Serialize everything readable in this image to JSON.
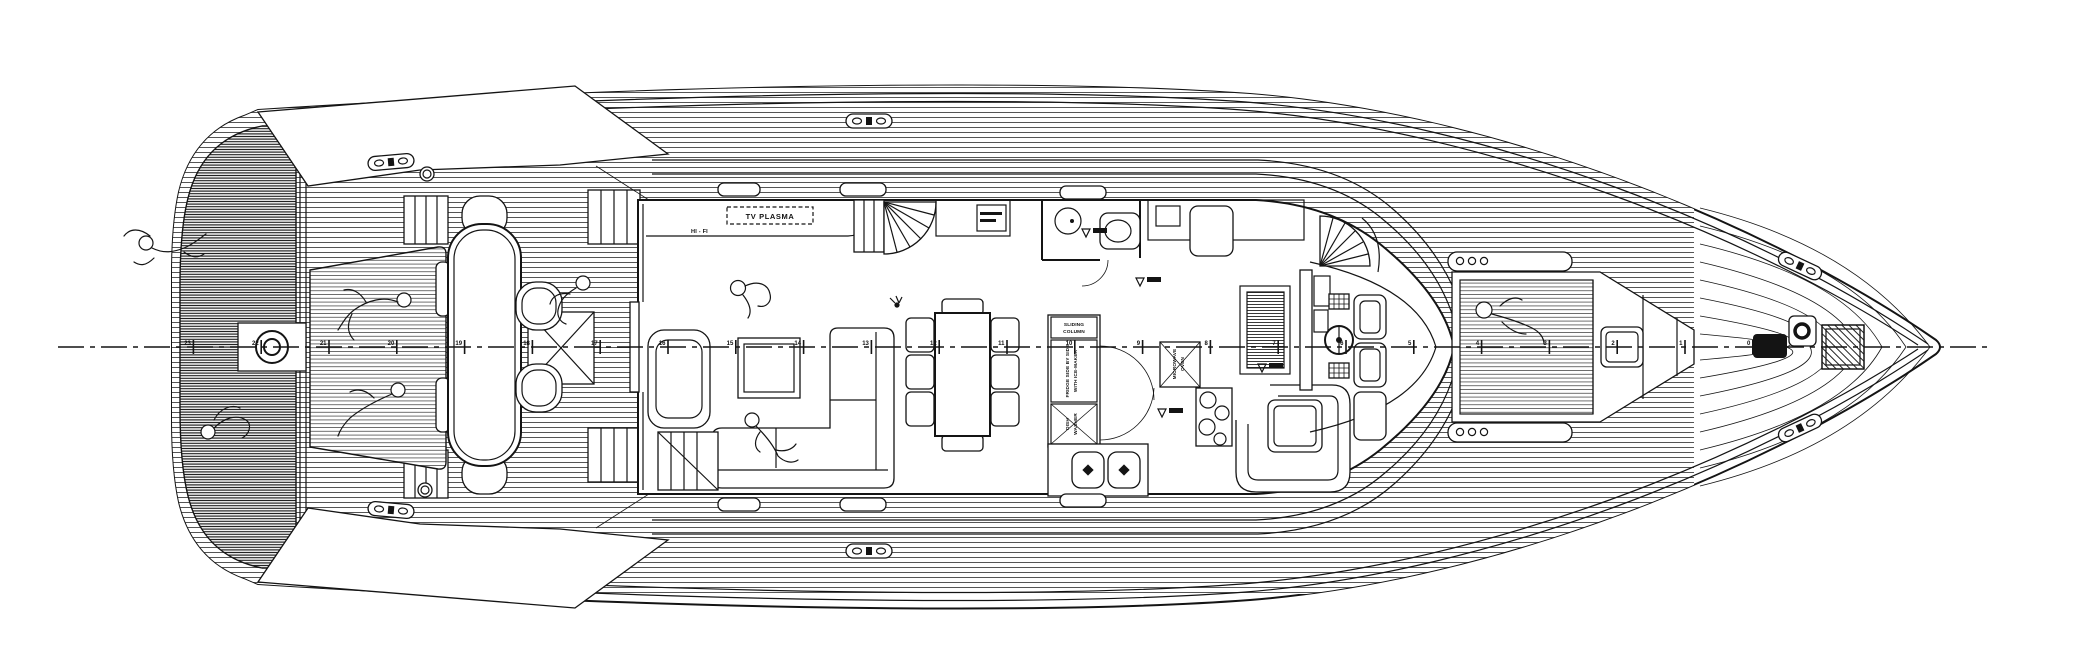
{
  "colors": {
    "ink": "#141414",
    "paper": "#ffffff"
  },
  "labels": {
    "tv_plasma": "TV PLASMA",
    "hi_fi": "HI - FI",
    "sliding_column_1": "SLIDING",
    "sliding_column_2": "COLUMN",
    "fridge_1": "FRIDGE SIDE BY SIDE",
    "fridge_2": "WITH ICE-MAKER",
    "dish_washer_1": "DISH",
    "dish_washer_2": "WASHER",
    "microwave_1": "MICROWAVE",
    "microwave_2": "OVEN"
  },
  "stations": {
    "start_x": 193.4,
    "spacing": 67.8,
    "y": 347,
    "numbers": [
      23,
      22,
      21,
      20,
      19,
      18,
      17,
      16,
      15,
      14,
      13,
      12,
      11,
      10,
      9,
      8,
      7,
      6,
      5,
      4,
      3,
      2,
      1,
      0
    ]
  }
}
